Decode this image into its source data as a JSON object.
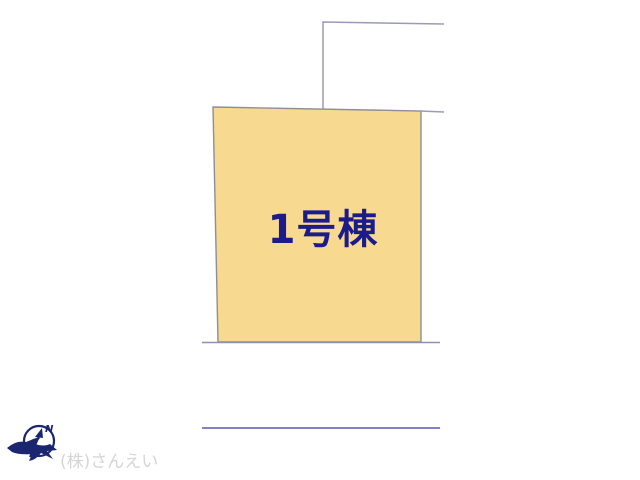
{
  "plan": {
    "building_label": "1号棟",
    "watermark": "(株)さんえい",
    "compass": {
      "north_label": "N"
    },
    "colors": {
      "parcel_fill": "#F8D990",
      "parcel_border": "#8E8E96",
      "boundary_line": "#9A9ABC",
      "road_line": "#8282C6",
      "building_label_color": "#1B1B8A",
      "compass_color": "#1B2670",
      "watermark_color": "#D5D5D5"
    }
  }
}
